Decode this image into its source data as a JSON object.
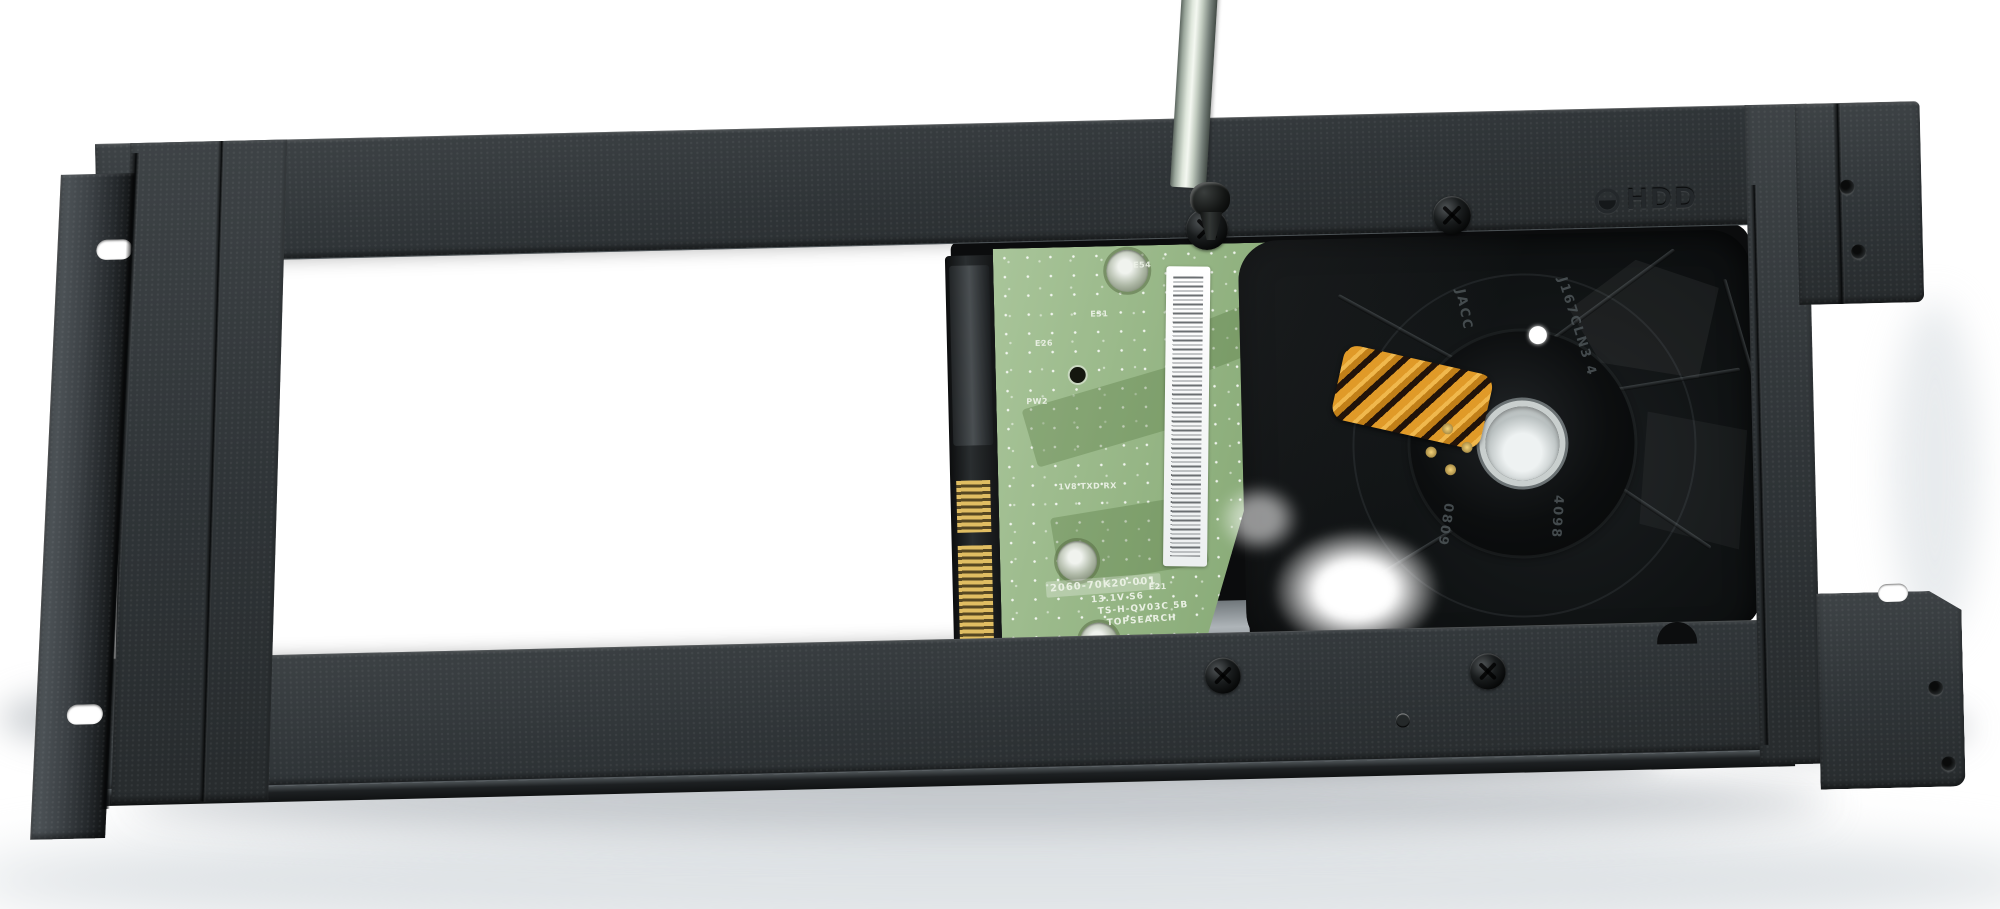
{
  "colors": {
    "background": "#ffffff",
    "bracket": "#32373a",
    "pcb": "#9cba8d",
    "flex_cable": "#e09a28",
    "drive_casting": "#121416",
    "screwdriver_shaft": "#dfe7dc"
  },
  "bracket": {
    "emboss_label": "HDD",
    "emboss_icon": "screw-head-icon"
  },
  "drive": {
    "silkscreen_labels": [
      "E54",
      "E28",
      "E56",
      "E66",
      "E34",
      "E26",
      "E31",
      "E30",
      "E52 E32",
      "PW2",
      "1V8 TXD RX",
      "E21"
    ],
    "board_markings": [
      "2060-70K20-001",
      "13.1V S6",
      "TS-H-QV03C 5B",
      "TOPSEARCH"
    ],
    "casting_engravings": [
      "JACC",
      "J167CLN3 4",
      "0809",
      "4098"
    ]
  }
}
